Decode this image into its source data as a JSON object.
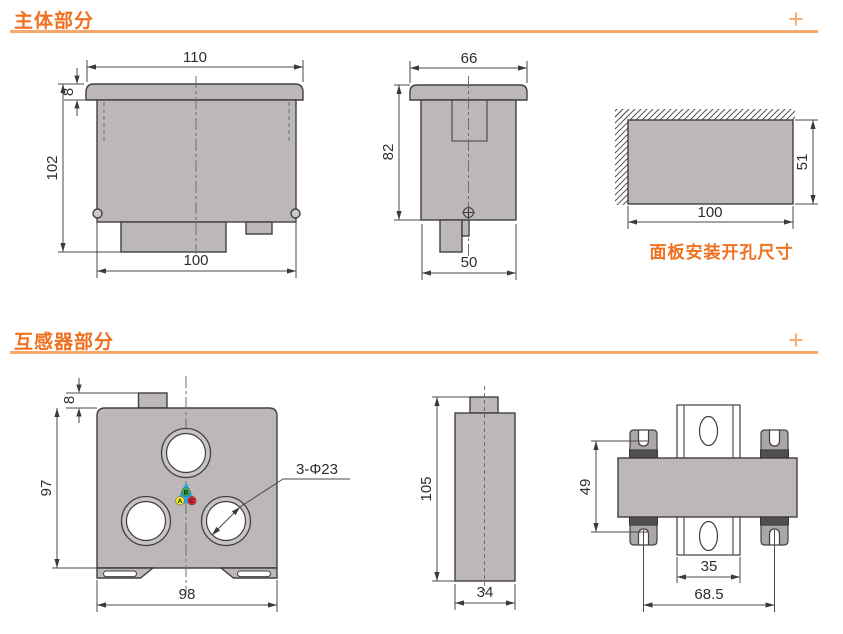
{
  "colors": {
    "accent_orange": "#F0701F",
    "accent_light_orange": "#F5A96E",
    "drawing_fill_gray": "#BDB7B7",
    "line_dark": "#404040",
    "clip_dark": "#4F4F4F",
    "marker_triangle_blue": "#2BA9E0",
    "phase_a_yellow": "#F5EB1E",
    "phase_b_green": "#3AB54A",
    "phase_c_red": "#E8212E"
  },
  "sections": {
    "main": {
      "title": "主体部分",
      "plus": "+"
    },
    "ct": {
      "title": "互感器部分",
      "plus": "+"
    }
  },
  "drawings": {
    "main_front": {
      "dim_flange_width": "110",
      "dim_bezel_thickness": "8",
      "dim_height": "102",
      "dim_mount_span": "100"
    },
    "main_side": {
      "dim_width": "66",
      "dim_depth": "82",
      "dim_bottom": "50"
    },
    "panel_cutout": {
      "dim_width": "100",
      "dim_height": "51",
      "caption": "面板安装开孔尺寸"
    },
    "ct_front": {
      "dim_tab": "8",
      "dim_height": "97",
      "dim_width": "98",
      "hole_label": "3-Φ23",
      "phase_a": "A",
      "phase_b": "B",
      "phase_c": "C"
    },
    "ct_side": {
      "dim_height": "105",
      "dim_width": "34"
    },
    "ct_top": {
      "dim_height": "49",
      "dim_rail": "35",
      "dim_span": "68.5"
    }
  }
}
